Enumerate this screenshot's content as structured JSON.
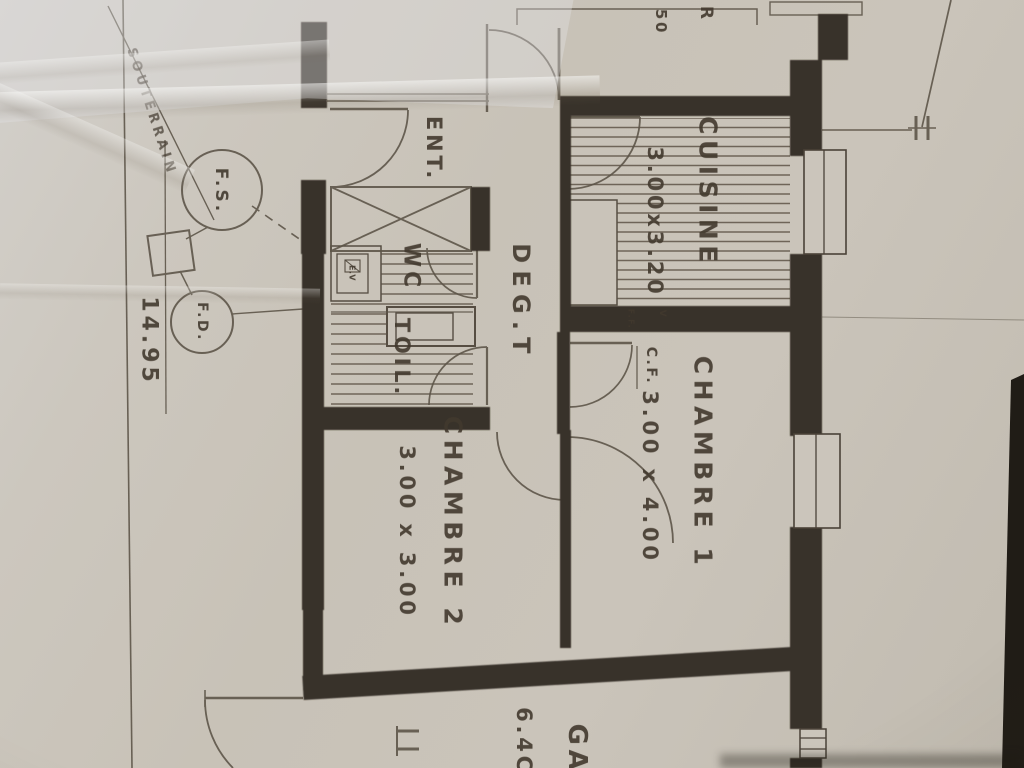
{
  "plan": {
    "rooms": {
      "entrance": {
        "label": "ENT."
      },
      "kitchen": {
        "label": "CUISINE",
        "dim": "3.00x3.20"
      },
      "hallway": {
        "label": "DEG.T"
      },
      "wc": {
        "label": "WC"
      },
      "toilet": {
        "label": "TOIL."
      },
      "bedroom1": {
        "label": "CHAMBRE 1",
        "dim": "3.00 x 4.00"
      },
      "bedroom2": {
        "label": "CHAMBRE 2",
        "dim": "3.00 x 3.00"
      },
      "garage": {
        "label": "GA",
        "dim": "6.4C"
      }
    },
    "annotations": {
      "air_vent": "E.V",
      "flue": "C.F.",
      "flue_small": "F.F.",
      "vent_mark": "V",
      "septic_tank": "F.S.",
      "drain": "F.D.",
      "underground": "SOUTERRAIN",
      "boundary_length": "14.95",
      "top_letter": "R",
      "top_dim": "50"
    },
    "colors": {
      "paper": "#c9c3b9",
      "ink": "#37302a",
      "pencil": "#5d5549",
      "handtext": "#42392e"
    }
  }
}
